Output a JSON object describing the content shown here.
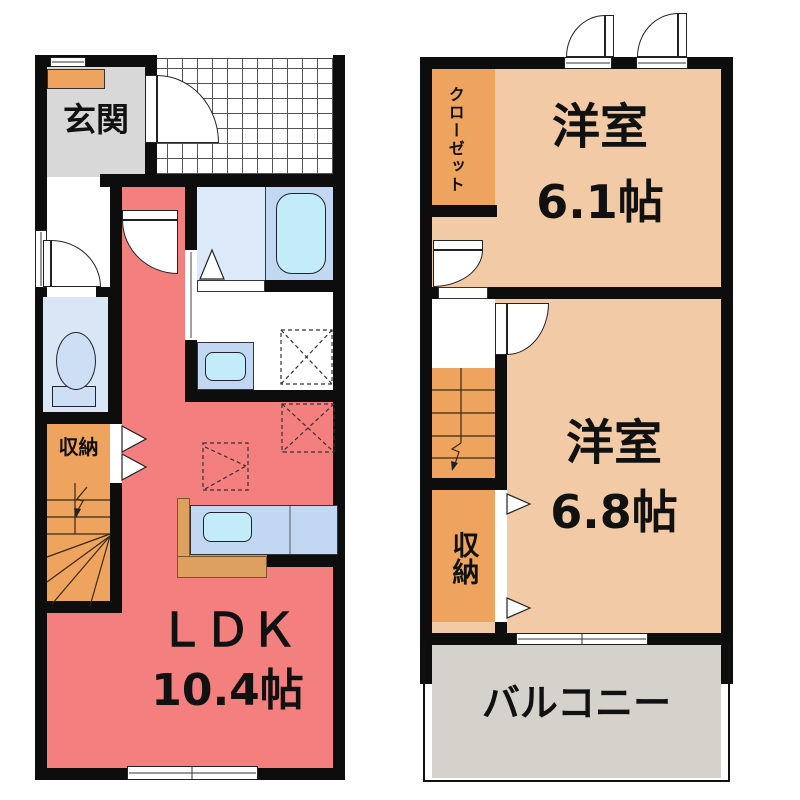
{
  "floor1": {
    "genkan_label": "玄関",
    "storage_label": "収納",
    "ldk_label": "ＬＤＫ",
    "ldk_size": "10.4帖"
  },
  "floor2": {
    "closet_label": "クローゼット",
    "room_a_label": "洋室",
    "room_a_size": "6.1帖",
    "room_b_label": "洋室",
    "room_b_size": "6.8帖",
    "storage_label": "収納",
    "balcony_label": "バルコニー"
  },
  "colors": {
    "wall": "#0d0d0d",
    "ldk_floor": "#F47F7F",
    "genkan_floor": "#D8D8D8",
    "wood_accent": "#EEA45F",
    "kitchen_counter": "#DDA05E",
    "bedroom_floor": "#F2CBA6",
    "balcony_floor": "#D5D1CB",
    "bath_floor": "#DCE9F8",
    "fixture_blue": "#C2D8F2",
    "fixture_cyan": "#C3ECF8"
  }
}
